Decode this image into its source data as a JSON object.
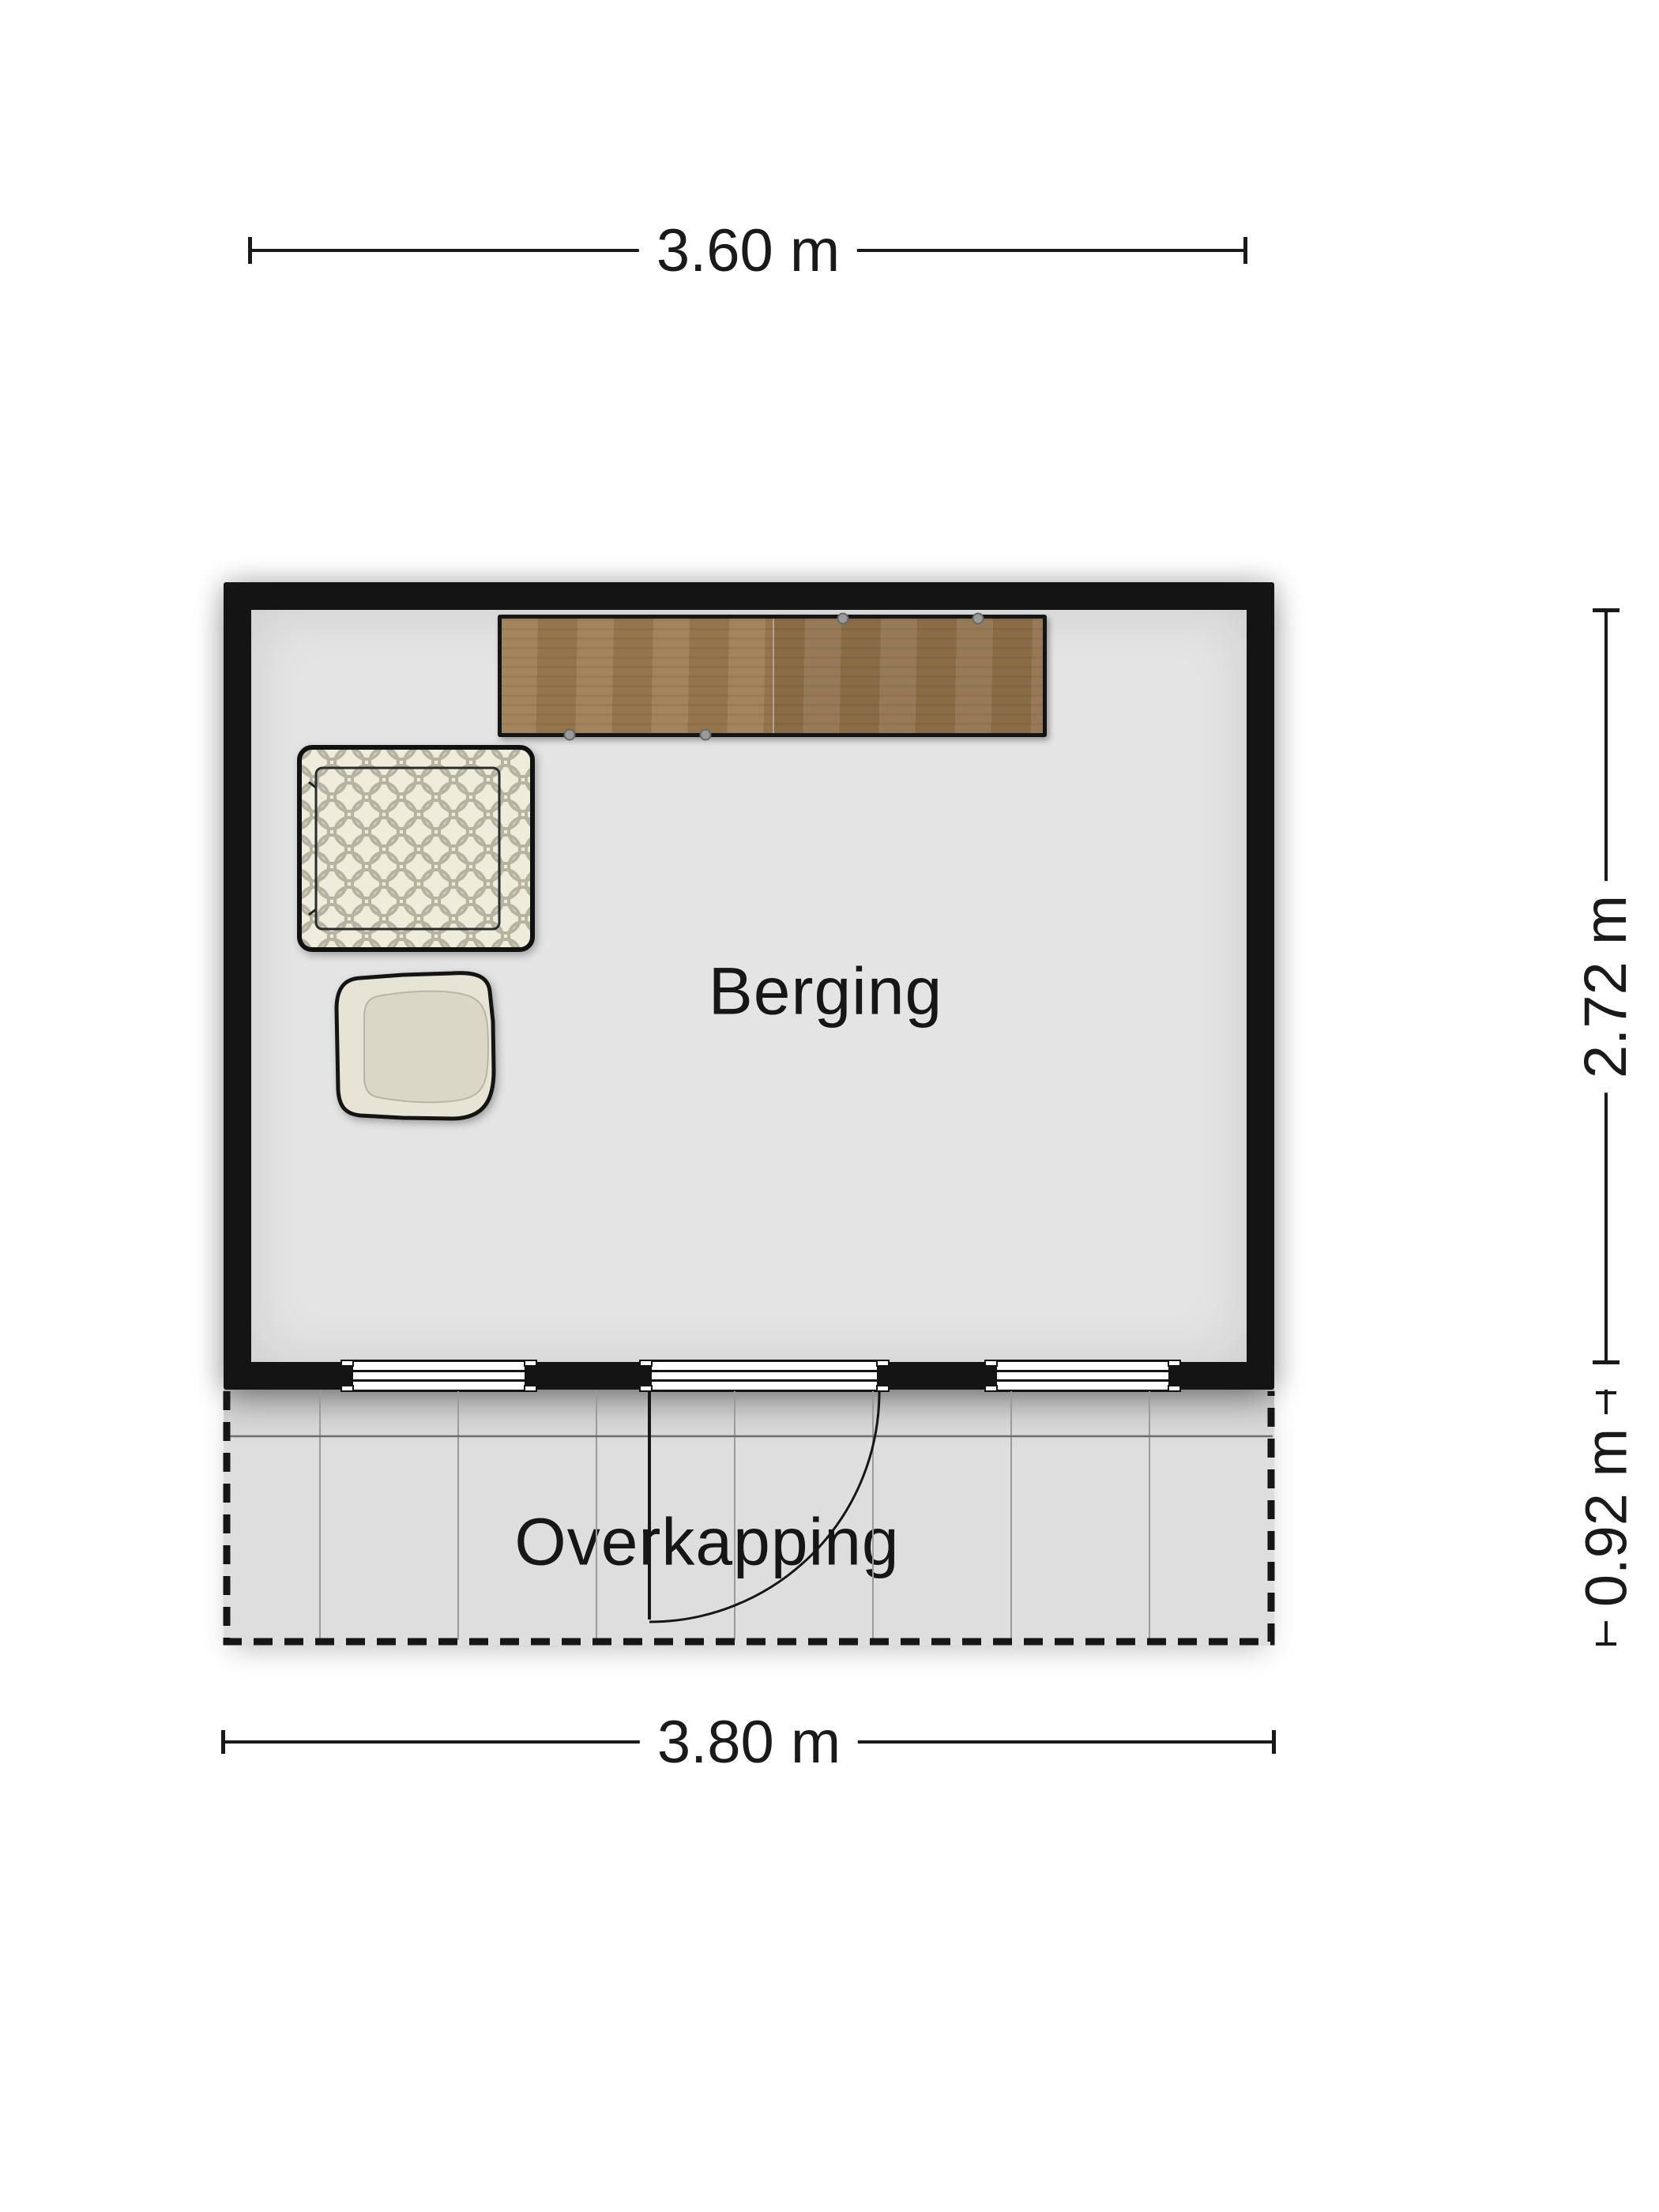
{
  "labels": {
    "room": "Berging",
    "canopy": "Overkapping"
  },
  "dimensions": {
    "top_width": "3.60 m",
    "bottom_width": "3.80 m",
    "room_depth": "2.72 m",
    "canopy_depth": "0.92 m"
  },
  "colors": {
    "wall": "#141414",
    "room-floor": "#e4e4e4",
    "canopy-floor": "#dedede",
    "wood": "#9c7b50",
    "fabric-cream": "#efecdc",
    "pattern-gray": "#b7b3a1",
    "chair-cream": "#e7e4d5",
    "chair-seat": "#dbd7c6",
    "grid-line": "#9b9b9b",
    "line": "#1a1a1a",
    "background": "#ffffff"
  }
}
